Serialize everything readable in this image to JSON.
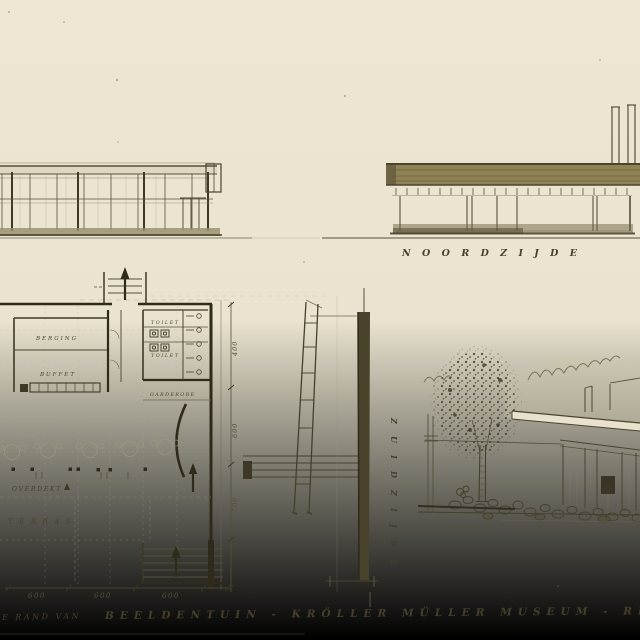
{
  "drawing_meta": {
    "type": "architectural-sketch",
    "paper_color": "#e9e3cf",
    "ink_color": "#3e3826",
    "roof_band_color": "#8d8256"
  },
  "title_block": {
    "left_fragment": "E RAND VAN",
    "main_fragment": "BEELDENTUIN - KRÖLLER MÜLLER MUSEUM - RI"
  },
  "north_elevation": {
    "label": "NOORDZIJDE"
  },
  "section": {
    "vertical_label": "ZUIDZIJDE"
  },
  "floor_plan": {
    "room_labels": {
      "berging": "BERGING",
      "buffet": "BUFFET",
      "toilet_top": "TOILET",
      "toilet_bottom": "TOILET",
      "garderobe": "GARDEROBE",
      "overdekt": "OVERDEKT",
      "terras": "TERRAS"
    },
    "dimensions_bottom": [
      "600",
      "600",
      "600"
    ],
    "dimensions_right": [
      "400",
      "600",
      "700"
    ]
  }
}
